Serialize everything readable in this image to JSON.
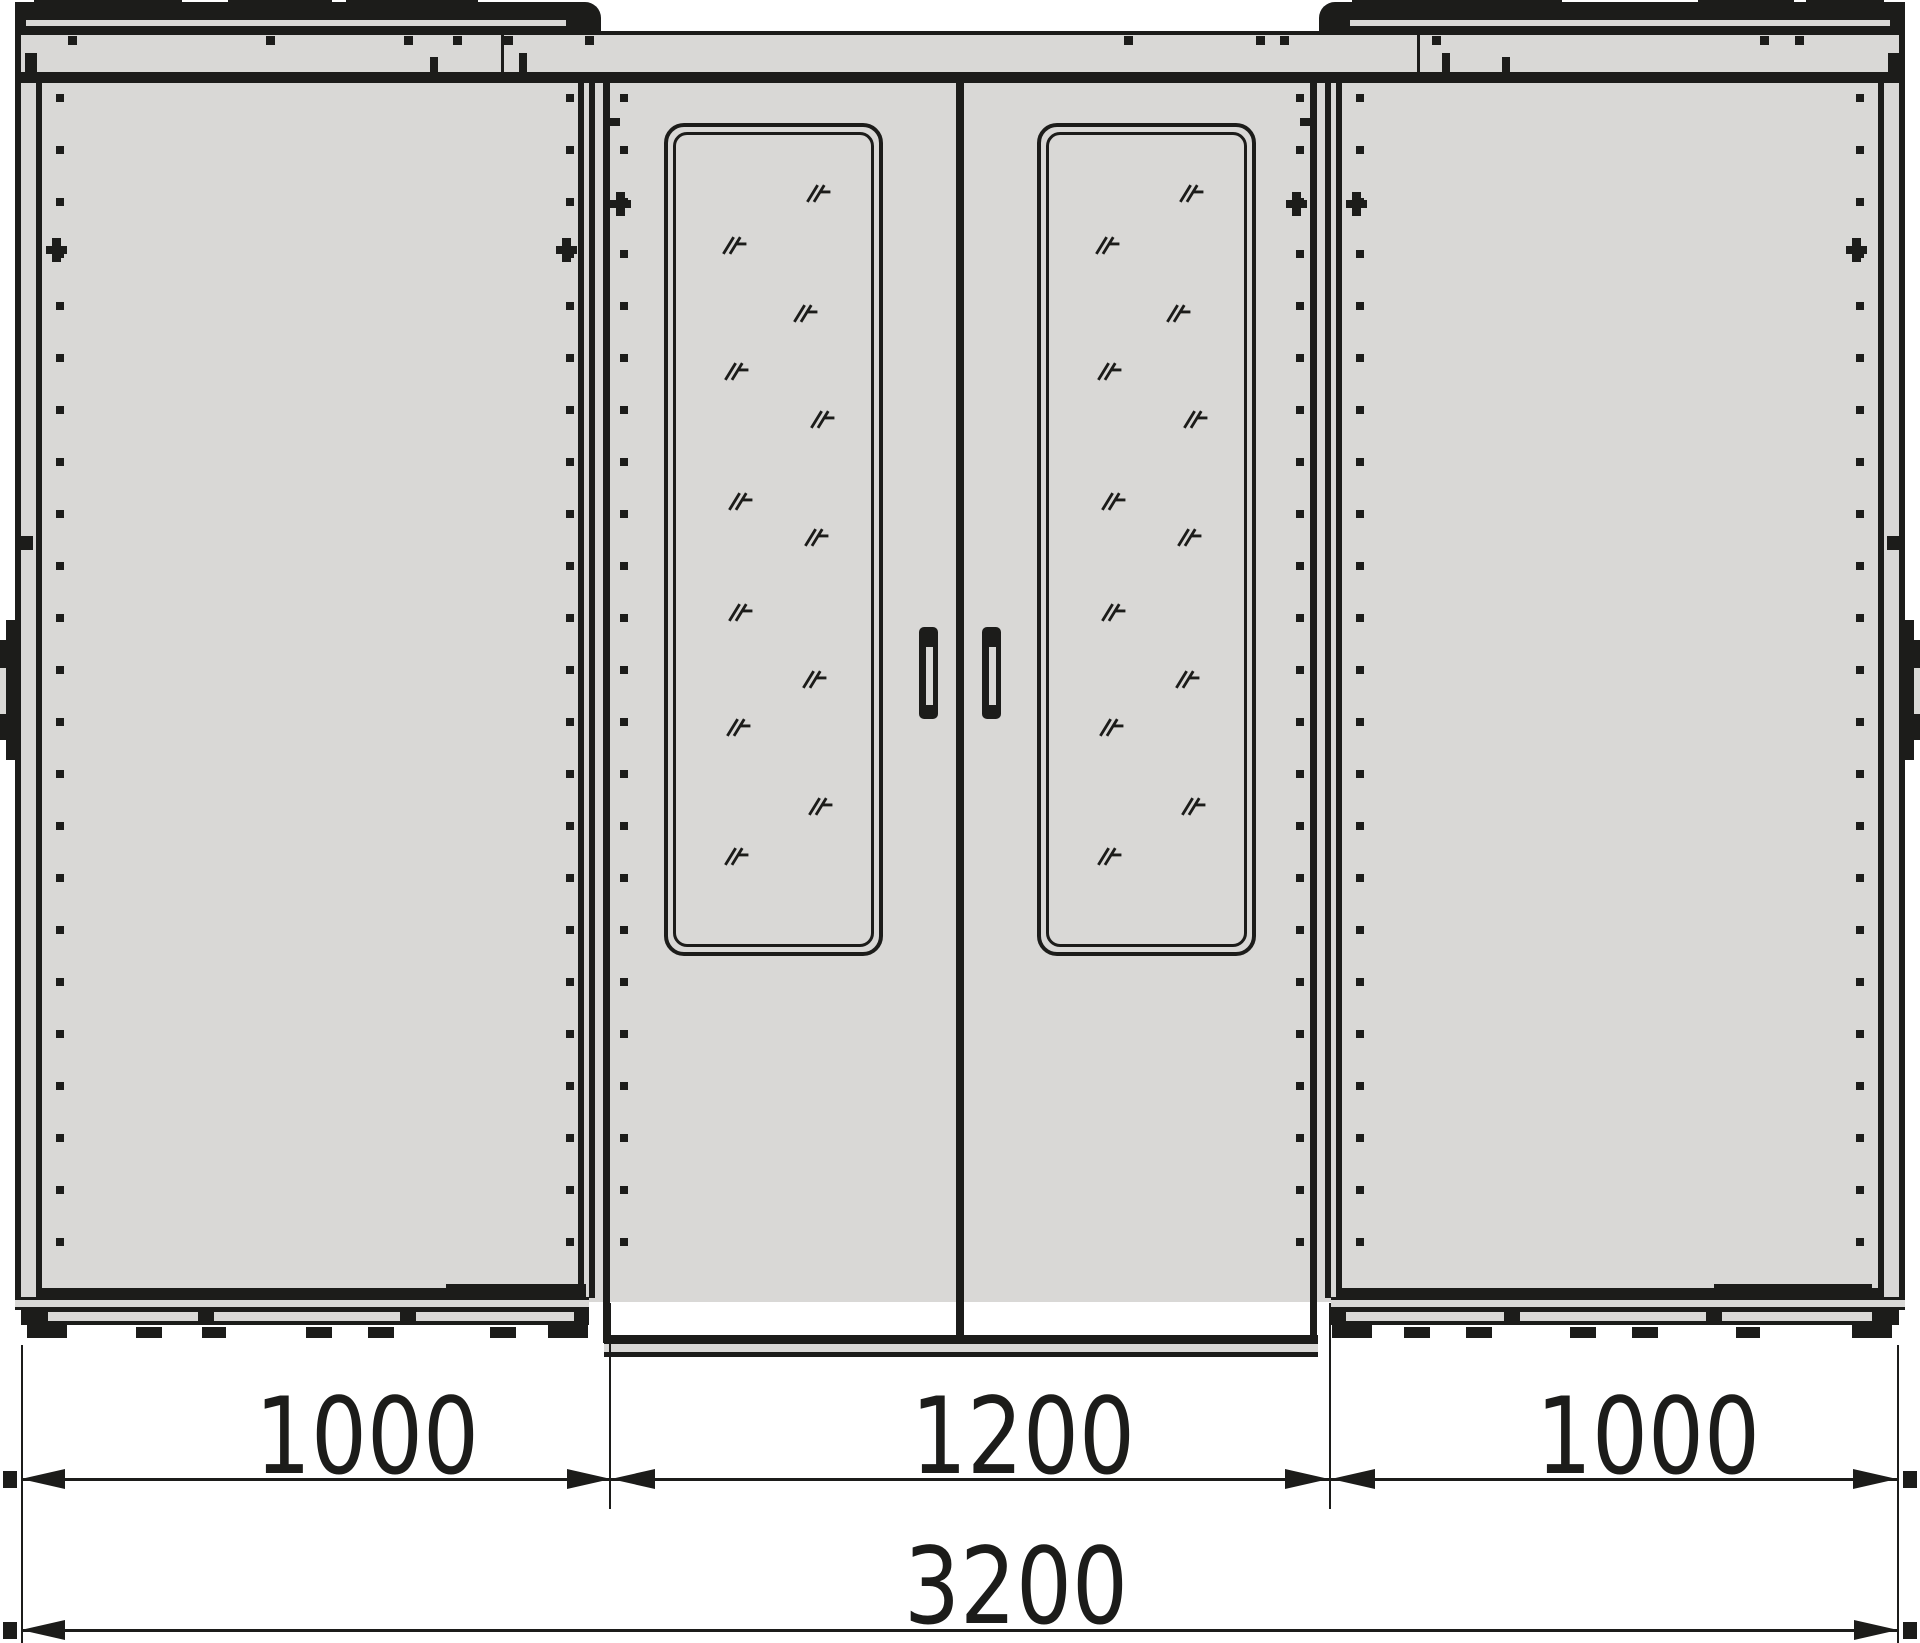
{
  "colors": {
    "line": "#1c1c1a",
    "panel": "#d9d8d6",
    "background": "#ffffff"
  },
  "drawing": {
    "kind": "enclosure-suite-front-elevation",
    "bays": [
      {
        "name": "left-bay",
        "width_label": "1000",
        "door_count": 1
      },
      {
        "name": "center-bay",
        "width_label": "1200",
        "door_count": 2,
        "glazed": true
      },
      {
        "name": "right-bay",
        "width_label": "1000",
        "door_count": 1
      }
    ],
    "dimensions": {
      "left": "1000",
      "center": "1200",
      "right": "1000",
      "total": "3200"
    },
    "windows": {
      "count": 2,
      "marks": [
        [
          0.64,
          0.067
        ],
        [
          0.24,
          0.13
        ],
        [
          0.58,
          0.212
        ],
        [
          0.25,
          0.282
        ],
        [
          0.66,
          0.34
        ],
        [
          0.27,
          0.44
        ],
        [
          0.63,
          0.484
        ],
        [
          0.27,
          0.574
        ],
        [
          0.62,
          0.656
        ],
        [
          0.26,
          0.714
        ],
        [
          0.65,
          0.81
        ],
        [
          0.25,
          0.87
        ]
      ]
    },
    "handles": {
      "count": 2
    }
  }
}
